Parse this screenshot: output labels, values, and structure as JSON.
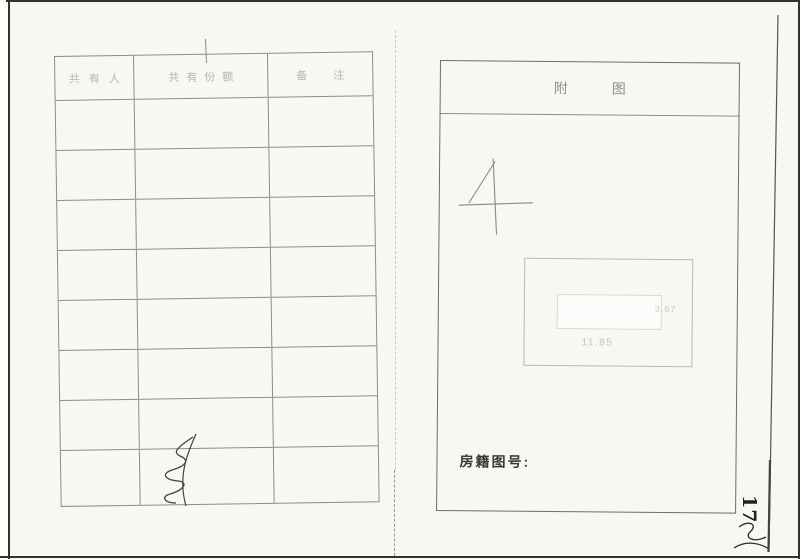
{
  "left_page": {
    "table": {
      "headers": [
        "共有人",
        "共有份额",
        "备注"
      ],
      "empty_row_count": 8
    }
  },
  "right_page": {
    "title": "附图",
    "sheet_number": "4",
    "diagram": {
      "side_label": "3.67",
      "bottom_label": "11.85"
    },
    "footer_label": "房籍图号:"
  },
  "page_number": "17",
  "colors": {
    "paper": "#f8f7f4",
    "frame": "#34322f",
    "grid_line": "#8d8c89",
    "faint_header_text": "#b7b4af",
    "title_text": "#908e8a",
    "dark_text": "#3b3936"
  }
}
